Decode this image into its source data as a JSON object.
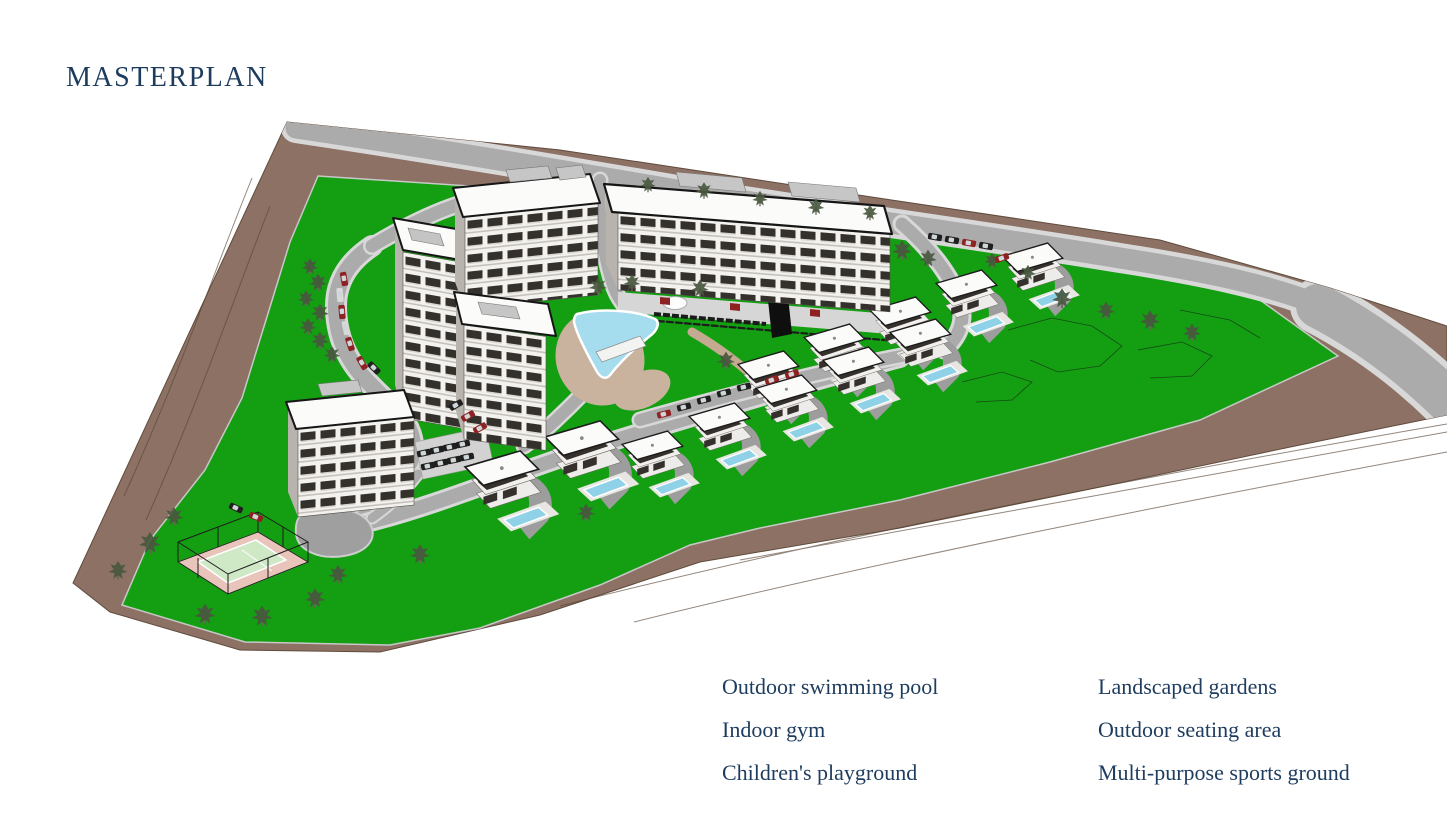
{
  "page": {
    "title": "MASTERPLAN",
    "background_color": "#ffffff",
    "text_color": "#1d3c5e"
  },
  "rendering": {
    "label": "3d-aerial-masterplan-rendering",
    "features": [
      "apartment-buildings",
      "villas-with-private-pools",
      "central-swimming-pool",
      "tennis-court",
      "perimeter-road",
      "internal-roads",
      "parking-areas",
      "landscaped-lawns",
      "terrain-slopes",
      "trees",
      "parked-cars",
      "pool-deck",
      "fountain",
      "water-feature-wall"
    ],
    "colors": {
      "grass": "#149e12",
      "terrain": "#8c7164",
      "terrain_contour": "#5a4636",
      "road_core": "#ababab",
      "road_edge": "#d8d8d8",
      "pool_water": "#a5dcee",
      "villa_pool_water": "#8fd2e8",
      "pool_deck": "#c9b29e",
      "facade": "#f3f2ef",
      "facade_accent": "#34302c",
      "roof": "#fbfbfa",
      "court_apron": "#e9c4ba",
      "court_surface": "#cfe8c6",
      "car_red": "#8e2222",
      "car_dark": "#1f1f1f"
    }
  },
  "amenities": {
    "left_column": [
      "Outdoor swimming pool",
      "Indoor gym",
      "Children's playground"
    ],
    "right_column": [
      "Landscaped gardens",
      "Outdoor seating area",
      "Multi-purpose sports ground"
    ]
  }
}
